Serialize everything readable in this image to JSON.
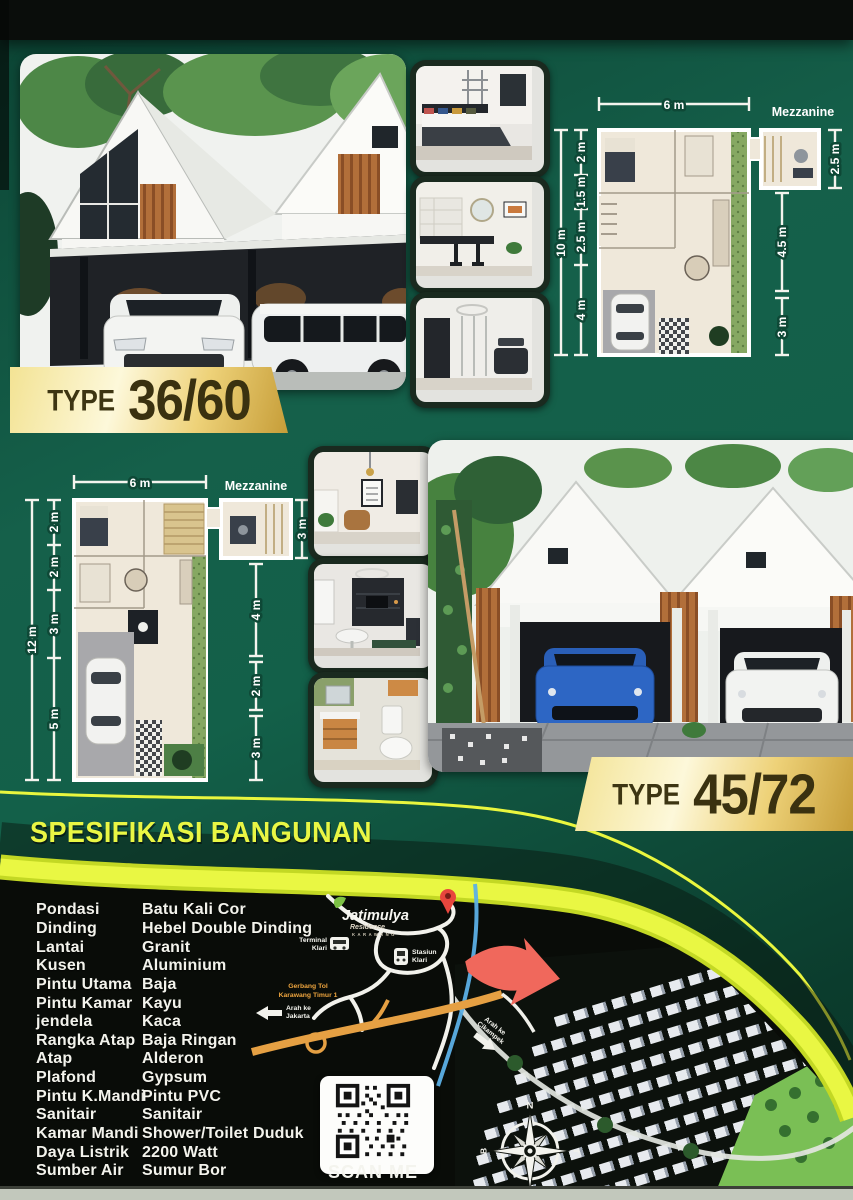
{
  "flyer": {
    "badge_a": {
      "prefix": "TYPE",
      "value": "36/60"
    },
    "badge_b": {
      "prefix": "TYPE",
      "value": "45/72"
    }
  },
  "plan_a": {
    "width": "6 m",
    "mezzanine": "Mezzanine",
    "total": "10 m",
    "left": [
      "2 m",
      "1.5 m",
      "2.5 m",
      "4 m"
    ],
    "right": [
      "2.5 m",
      "4.5 m",
      "3 m"
    ]
  },
  "plan_b": {
    "width": "6 m",
    "mezzanine": "Mezzanine",
    "total": "12 m",
    "left": [
      "2 m",
      "2 m",
      "3 m",
      "5 m"
    ],
    "right": [
      "3 m",
      "4 m",
      "2 m",
      "3 m"
    ]
  },
  "specs": {
    "title": "SPESIFIKASI BANGUNAN",
    "items": [
      {
        "label": "Pondasi",
        "value": "Batu Kali Cor"
      },
      {
        "label": "Dinding",
        "value": "Hebel Double Dinding"
      },
      {
        "label": "Lantai",
        "value": "Granit"
      },
      {
        "label": "Kusen",
        "value": "Aluminium"
      },
      {
        "label": "Pintu Utama",
        "value": "Baja"
      },
      {
        "label": "Pintu Kamar",
        "value": "Kayu"
      },
      {
        "label": "jendela",
        "value": "Kaca"
      },
      {
        "label": "Rangka Atap",
        "value": "Baja Ringan"
      },
      {
        "label": "Atap",
        "value": "Alderon"
      },
      {
        "label": "Plafond",
        "value": "Gypsum"
      },
      {
        "label": "Pintu K.Mandi",
        "value": "Pintu PVC"
      },
      {
        "label": "Sanitair",
        "value": "Sanitair"
      },
      {
        "label": "Kamar Mandi",
        "value": "Shower/Toilet Duduk"
      },
      {
        "label": "Daya Listrik",
        "value": "2200 Watt"
      },
      {
        "label": "Sumber Air",
        "value": "Sumur Bor"
      }
    ]
  },
  "map": {
    "logo": {
      "name": "Jatimulya",
      "sub": "Residence",
      "city": "KARAWANG"
    },
    "terminal": {
      "line1": "Terminal",
      "line2": "Klari"
    },
    "station": {
      "line1": "Stasiun",
      "line2": "Klari"
    },
    "toll_gate": {
      "line1": "Gerbang Tol",
      "line2": "Karawang Timur 1"
    },
    "to_jakarta": {
      "line1": "Arah ke",
      "line2": "Jakarta"
    },
    "to_cikampek": {
      "line1": "Arah ke",
      "line2": "Cikampek"
    }
  },
  "qr": {
    "label": "SCAN ME"
  },
  "compass": {
    "north": "N",
    "east": "T",
    "south": "S",
    "west": "B"
  },
  "colors": {
    "background_green": "#14573f",
    "section_black": "#0a0d09",
    "accent_yellow": "#e8f53c",
    "badge_gold": "#eed279",
    "arrow_red": "#f0685c",
    "spec_text": "#f3f3ec",
    "toll_orange": "#e5a043",
    "river_blue": "#5cb0e6"
  }
}
